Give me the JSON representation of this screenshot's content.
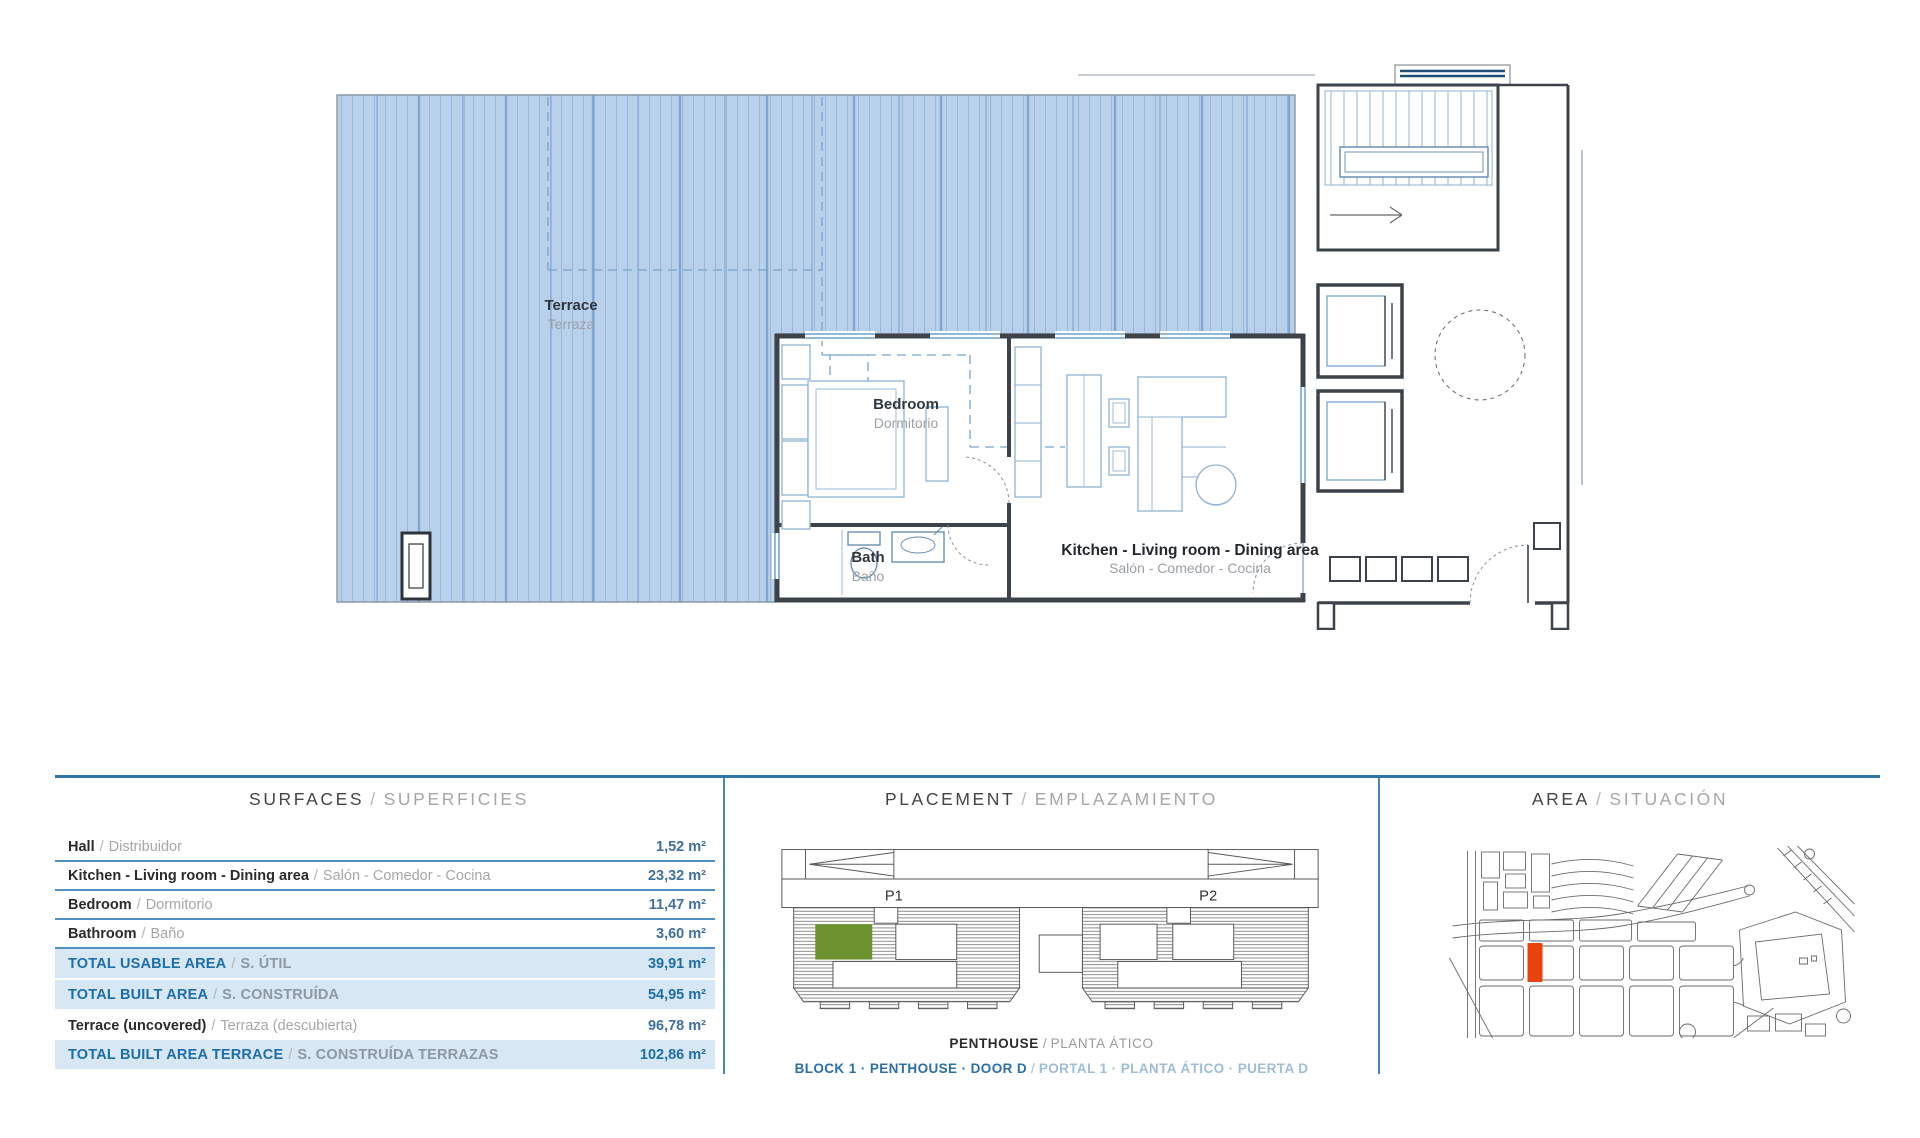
{
  "sep": "/",
  "plan": {
    "rooms": [
      {
        "name_en": "Terrace",
        "name_es": "Terraza"
      },
      {
        "name_en": "Bedroom",
        "name_es": "Dormitorio"
      },
      {
        "name_en": "Bath",
        "name_es": "Baño"
      },
      {
        "name_en": "Kitchen - Living room - Dining area",
        "name_es": "Salón - Comedor - Cocina"
      }
    ]
  },
  "surfaces": {
    "title_en": "SURFACES",
    "title_es": "SUPERFICIES",
    "rows": [
      {
        "en": "Hall",
        "es": "Distribuidor",
        "value": "1,52 m²",
        "highlight": false
      },
      {
        "en": "Kitchen - Living room - Dining area",
        "es": "Salón - Comedor - Cocina",
        "value": "23,32 m²",
        "highlight": false
      },
      {
        "en": "Bedroom",
        "es": "Dormitorio",
        "value": "11,47 m²",
        "highlight": false
      },
      {
        "en": "Bathroom",
        "es": "Baño",
        "value": "3,60 m²",
        "highlight": false
      },
      {
        "en": "TOTAL USABLE AREA",
        "es": "S. ÚTIL",
        "value": "39,91 m²",
        "highlight": true
      },
      {
        "en": "TOTAL BUILT AREA",
        "es": "S. CONSTRUÍDA",
        "value": "54,95 m²",
        "highlight": true
      },
      {
        "en": "Terrace (uncovered)",
        "es": "Terraza (descubierta)",
        "value": "96,78 m²",
        "highlight": false
      },
      {
        "en": "TOTAL BUILT AREA TERRACE",
        "es": "S. CONSTRUÍDA TERRAZAS",
        "value": "102,86 m²",
        "highlight": true
      }
    ]
  },
  "placement": {
    "title_en": "PLACEMENT",
    "title_es": "EMPLAZAMIENTO",
    "p1": "P1",
    "p2": "P2",
    "floor_en": "PENTHOUSE",
    "floor_es": "PLANTA ÁTICO",
    "unit_en": "BLOCK 1 · PENTHOUSE · DOOR D",
    "unit_es": "PORTAL 1 · PLANTA ÁTICO · PUERTA D"
  },
  "area": {
    "title_en": "AREA",
    "title_es": "SITUACIÓN"
  },
  "colors": {
    "accent_blue": "#2E75A8",
    "table_line_blue": "#4E8FC0",
    "highlight_bg": "#D8E7F4",
    "text_blue": "#1D6EA8",
    "terrace_fill": "#B9D0EA",
    "terrace_stripe": "#99B9DC",
    "unit_green": "#6D9330",
    "map_marker_red": "#E8430F",
    "wall_dark": "#3D434B",
    "furniture_blue": "#8FB2D2"
  }
}
